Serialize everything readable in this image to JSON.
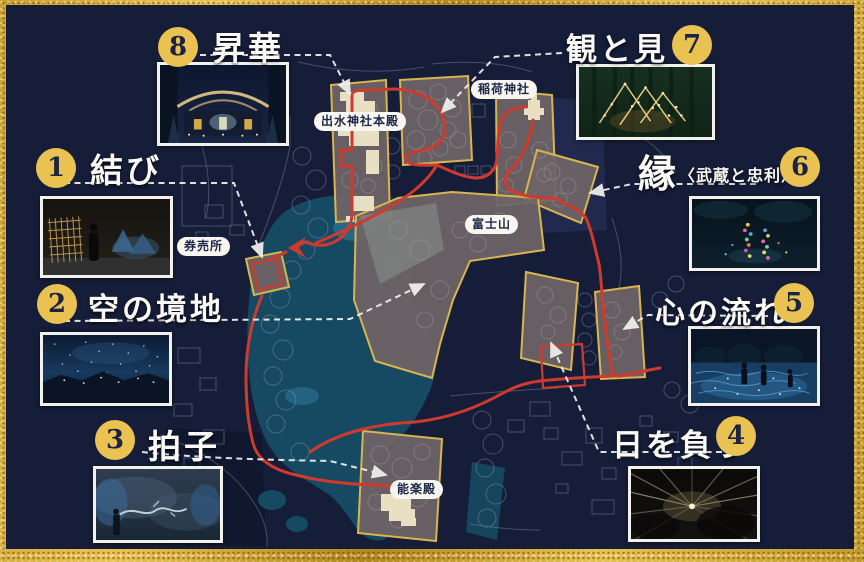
{
  "spots": [
    {
      "number": "1",
      "label": "結び"
    },
    {
      "number": "2",
      "label": "空の境地"
    },
    {
      "number": "3",
      "label": "拍子"
    },
    {
      "number": "4",
      "label": "日を負う"
    },
    {
      "number": "5",
      "label": "心の流れ"
    },
    {
      "number": "6",
      "label": "縁",
      "label_sub": "〈武蔵と忠利〉"
    },
    {
      "number": "7",
      "label": "観と見"
    },
    {
      "number": "8",
      "label": "昇華"
    }
  ],
  "map_labels": {
    "izumi_honden": "出水神社本殿",
    "inari": "稲荷神社",
    "fujisan": "富士山",
    "ticket_office": "券売所",
    "noh_stage": "能楽殿"
  },
  "colors": {
    "background_navy": "#151d38",
    "frame_gold": "#caa132",
    "badge_gold": "#e9c251",
    "badge_number_navy": "#1b2340",
    "route_red": "#cf3a2e",
    "zone_outline_gold": "#d9b54e",
    "zone_fill_gray": "#6f6467",
    "pond_teal": "#164a63",
    "building_cream": "#e9e0c4",
    "connector_white": "#f2f2ee",
    "pill_white": "#f8f6f0"
  },
  "photos": [
    {
      "id": "photo-1",
      "depicts": "warm lattice light installation with visitor silhouette"
    },
    {
      "id": "photo-2",
      "depicts": "deep blue starry sky over dark garden hills"
    },
    {
      "id": "photo-3",
      "depicts": "misty stage with white brush-stroke light and blue glow"
    },
    {
      "id": "photo-4",
      "depicts": "radiating light beams in darkness"
    },
    {
      "id": "photo-5",
      "depicts": "people standing on glowing blue water projection"
    },
    {
      "id": "photo-6",
      "depicts": "colorful dotted light figures in dark foliage"
    },
    {
      "id": "photo-7",
      "depicts": "forest with triangular golden string lights"
    },
    {
      "id": "photo-8",
      "depicts": "shrine facade illuminated with golden roof lights"
    }
  ]
}
